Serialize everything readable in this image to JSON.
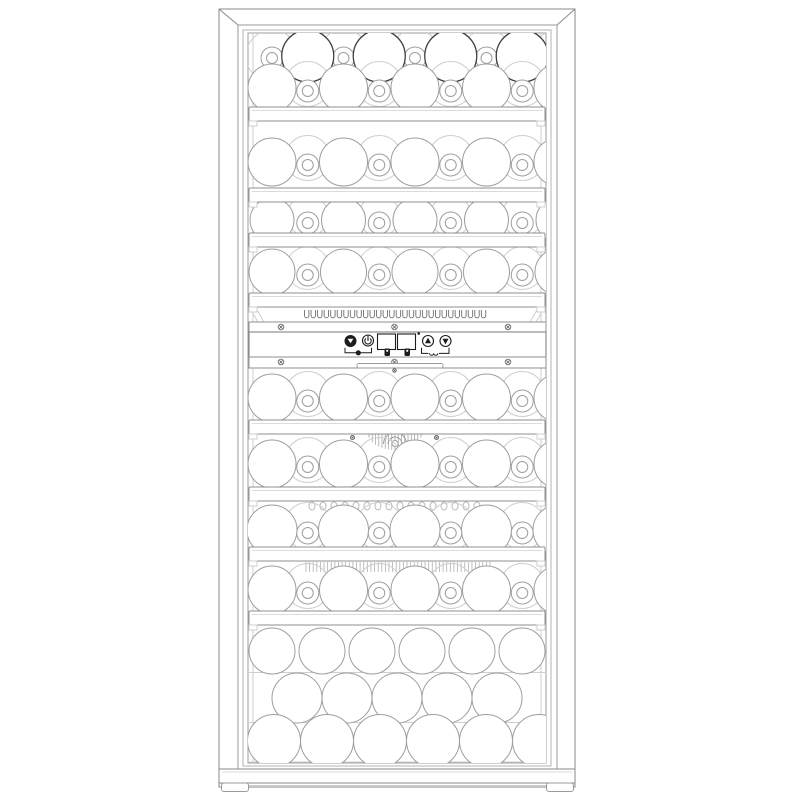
{
  "description": "Front-view technical line drawing of a tall dual-zone wine cooler with a framed glass door, eight bottle shelves, a central control strip and a bottom bulk-storage compartment",
  "colors": {
    "background": "#ffffff",
    "frame_line": "#8a8a8a",
    "door_line": "#9a9a9a",
    "glass_line": "#b3b3b3",
    "mid_line": "#9e9e9e",
    "light_line": "#cfcfcf",
    "dark_line": "#3f3f3f",
    "shelf_line": "#8f8f8f",
    "strip_line": "#a8a8a8",
    "control_ink": "#1c1c1c"
  },
  "rows": [
    {
      "name": "top-row-upper",
      "zone": "upper",
      "type": "interleaved",
      "cy": 56,
      "r": 26,
      "bottles": 4,
      "necks": 5
    },
    {
      "name": "top-row-lower",
      "zone": "upper",
      "type": "standard",
      "cy": 88,
      "r": 24,
      "bottles": 5,
      "necks": 4
    },
    {
      "name": "shelf-row-1",
      "zone": "upper",
      "type": "standard",
      "cy": 162,
      "r": 24,
      "bottles": 5,
      "necks": 4
    },
    {
      "name": "shelf-row-2",
      "zone": "upper",
      "type": "standard",
      "cy": 220,
      "r": 22,
      "bottles": 5,
      "necks": 4
    },
    {
      "name": "shelf-row-3",
      "zone": "upper",
      "type": "standard",
      "cy": 272,
      "r": 23,
      "bottles": 5,
      "necks": 4
    },
    {
      "name": "shelf-row-4",
      "zone": "lower",
      "type": "standard",
      "cy": 398,
      "r": 24,
      "bottles": 5,
      "necks": 4
    },
    {
      "name": "shelf-row-5",
      "zone": "lower",
      "type": "standard",
      "cy": 464,
      "r": 24,
      "bottles": 5,
      "necks": 4
    },
    {
      "name": "shelf-row-6",
      "zone": "lower",
      "type": "standard",
      "cy": 530,
      "r": 25,
      "bottles": 5,
      "necks": 4
    },
    {
      "name": "shelf-row-7",
      "zone": "lower",
      "type": "standard",
      "cy": 590,
      "r": 24,
      "bottles": 5,
      "necks": 4
    },
    {
      "name": "bulk-row-1",
      "zone": "bottom",
      "type": "plain",
      "cy": 651,
      "r": 23,
      "bottles": 6
    },
    {
      "name": "bulk-row-2",
      "zone": "bottom",
      "type": "plain",
      "cy": 698,
      "r": 25,
      "bottles": 5
    },
    {
      "name": "bulk-row-3",
      "zone": "bottom",
      "type": "plain",
      "cy": 741,
      "r": 26.5,
      "bottles": 6
    }
  ],
  "shelves": {
    "count": 8,
    "y_positions": [
      107,
      188,
      233,
      293,
      420,
      487,
      547,
      611
    ]
  },
  "strips": {
    "vent_slots": 28,
    "fan": true,
    "fan_screws": 2,
    "scallop_bumps": 16,
    "hatch_lines": 52
  },
  "control_panel": {
    "screw_bars": 2,
    "screws_per_bar": 3,
    "handle": true,
    "buttons": [
      {
        "name": "light-button",
        "glyph": "triangle-down",
        "style": "filled"
      },
      {
        "name": "power-button",
        "glyph": "power",
        "style": "outline"
      },
      {
        "name": "temp-up-button",
        "glyph": "triangle-up",
        "style": "outline"
      },
      {
        "name": "temp-down-button",
        "glyph": "triangle-down",
        "style": "outline"
      }
    ],
    "displays": [
      {
        "name": "upper-zone-display",
        "value": ""
      },
      {
        "name": "lower-zone-display",
        "value": ""
      }
    ],
    "indicator_dot": true,
    "group_markers": [
      "led-dot",
      "bottle-icon",
      "bottle-icon",
      "snow-icon"
    ]
  },
  "feet": {
    "count": 2
  }
}
